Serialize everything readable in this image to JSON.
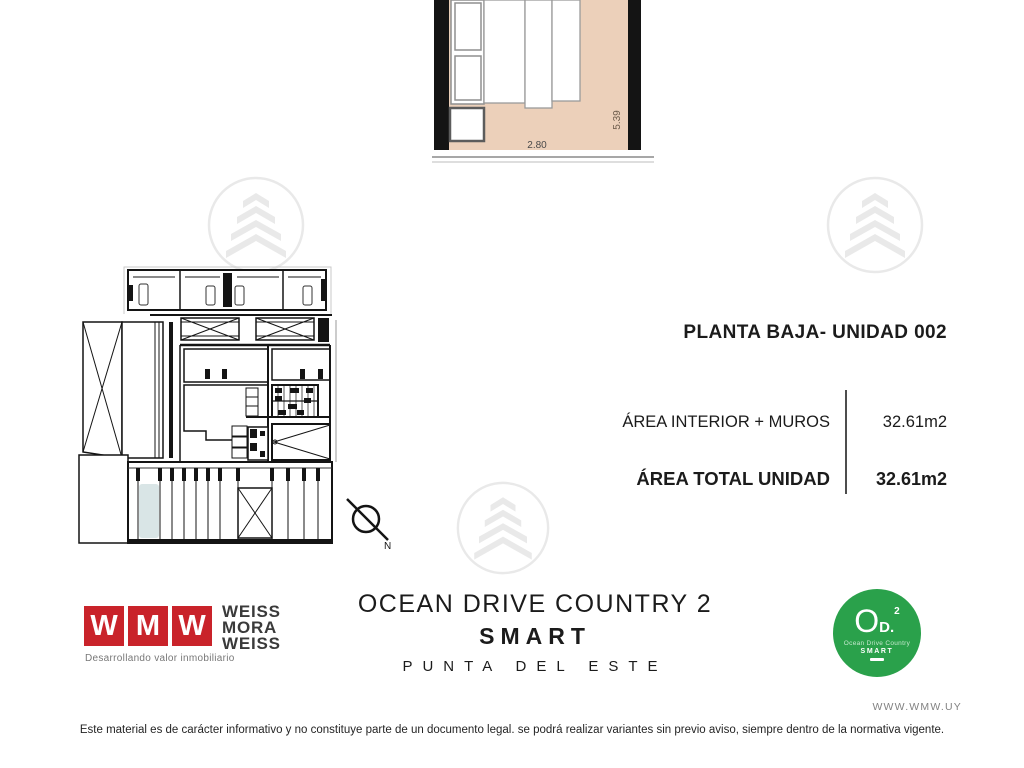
{
  "detail_plan": {
    "width_label": "2.80",
    "height_label": "5.39"
  },
  "info_panel": {
    "title": "PLANTA BAJA- UNIDAD 002",
    "rows": [
      {
        "label": "ÁREA INTERIOR + MUROS",
        "value": "32.61m2"
      },
      {
        "label": "ÁREA TOTAL UNIDAD",
        "value": "32.61m2"
      }
    ]
  },
  "floor_plan": {
    "north_label": "N"
  },
  "branding": {
    "wmw": {
      "squares": [
        "W",
        "M",
        "W"
      ],
      "name_lines": [
        "WEISS",
        "MORA",
        "WEISS"
      ],
      "tagline": "Desarrollando valor inmobiliario"
    },
    "project": {
      "title": "OCEAN DRIVE COUNTRY 2",
      "subtitle": "SMART",
      "location": "PUNTA DEL ESTE"
    },
    "badge": {
      "main": "O",
      "secondary": "D.",
      "superscript": "2",
      "line1": "Ocean Drive Country",
      "line2": "SMART"
    }
  },
  "footer": {
    "website": "WWW.WMW.UY",
    "disclaimer": "Este material es de carácter informativo y no constituye parte de un documento legal. se podrá realizar variantes sin previo aviso, siempre dentro de la normativa vigente."
  },
  "colors": {
    "accent_red": "#c9232a",
    "accent_green": "#2aa14b",
    "floor_tan": "#ecd0ba",
    "highlight_unit": "#d9e5e6"
  }
}
